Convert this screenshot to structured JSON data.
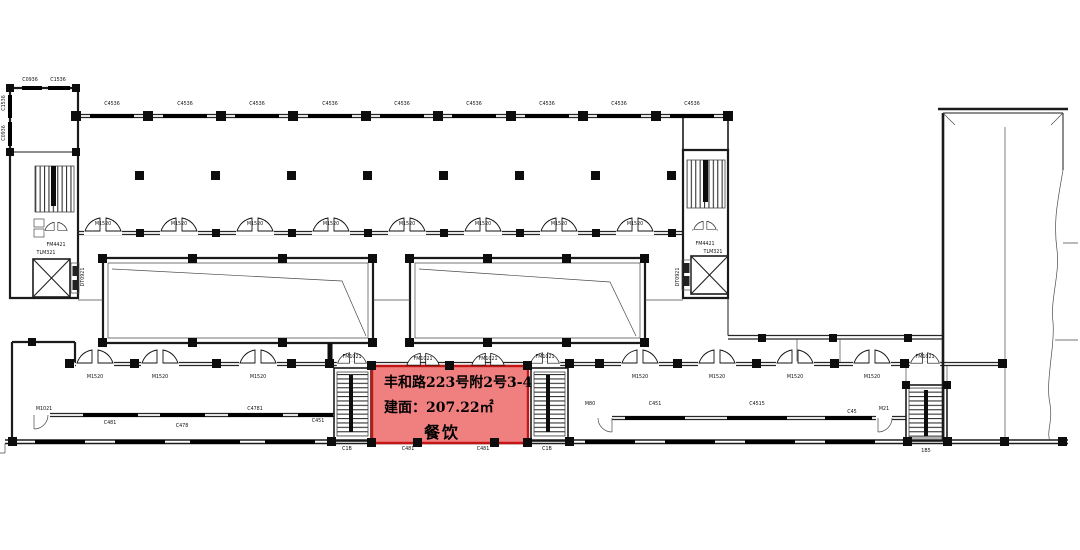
{
  "highlight": {
    "address": "丰和路223号附2号3-4",
    "area_label": "建面：207.22㎡",
    "usage": "餐饮",
    "fill_color": "#F08080",
    "border_color": "#C41414"
  },
  "plan": {
    "line_color": "#1b1b1b",
    "labels": [
      {
        "t": "C0936",
        "x": 30,
        "y": 80
      },
      {
        "t": "C1536",
        "x": 58,
        "y": 80
      },
      {
        "t": "C1536",
        "x": 4,
        "y": 103,
        "r": 1
      },
      {
        "t": "C0936",
        "x": 4,
        "y": 133,
        "r": 1
      },
      {
        "t": "C4536",
        "x": 112,
        "y": 104
      },
      {
        "t": "C4536",
        "x": 185,
        "y": 104
      },
      {
        "t": "C4536",
        "x": 257,
        "y": 104
      },
      {
        "t": "C4536",
        "x": 330,
        "y": 104
      },
      {
        "t": "C4536",
        "x": 402,
        "y": 104
      },
      {
        "t": "C4536",
        "x": 474,
        "y": 104
      },
      {
        "t": "C4536",
        "x": 547,
        "y": 104
      },
      {
        "t": "C4536",
        "x": 619,
        "y": 104
      },
      {
        "t": "C4536",
        "x": 692,
        "y": 104
      },
      {
        "t": "M1520",
        "x": 103,
        "y": 224
      },
      {
        "t": "M1520",
        "x": 179,
        "y": 224
      },
      {
        "t": "M1520",
        "x": 255,
        "y": 224
      },
      {
        "t": "M1520",
        "x": 331,
        "y": 224
      },
      {
        "t": "M1520",
        "x": 407,
        "y": 224
      },
      {
        "t": "M1520",
        "x": 483,
        "y": 224
      },
      {
        "t": "M1520",
        "x": 559,
        "y": 224
      },
      {
        "t": "M1520",
        "x": 635,
        "y": 224
      },
      {
        "t": "FM4421",
        "x": 56,
        "y": 245
      },
      {
        "t": "TLM321",
        "x": 46,
        "y": 253
      },
      {
        "t": "DT0921",
        "x": 83,
        "y": 277,
        "r": 1
      },
      {
        "t": "FM4421",
        "x": 705,
        "y": 244
      },
      {
        "t": "TLM321",
        "x": 713,
        "y": 252
      },
      {
        "t": "DT0921",
        "x": 678,
        "y": 277,
        "r": 1
      },
      {
        "t": "M1520",
        "x": 95,
        "y": 377
      },
      {
        "t": "M1520",
        "x": 160,
        "y": 377
      },
      {
        "t": "M1520",
        "x": 258,
        "y": 377
      },
      {
        "t": "M1520",
        "x": 640,
        "y": 377
      },
      {
        "t": "M1520",
        "x": 717,
        "y": 377
      },
      {
        "t": "M1520",
        "x": 795,
        "y": 377
      },
      {
        "t": "M1520",
        "x": 872,
        "y": 377
      },
      {
        "t": "FM1021",
        "x": 423,
        "y": 359
      },
      {
        "t": "FM1021",
        "x": 488,
        "y": 359
      },
      {
        "t": "FM1021",
        "x": 352,
        "y": 357
      },
      {
        "t": "FM1021",
        "x": 545,
        "y": 357
      },
      {
        "t": "FM1021",
        "x": 925,
        "y": 357
      },
      {
        "t": "M1021",
        "x": 44,
        "y": 409
      },
      {
        "t": "C481",
        "x": 110,
        "y": 423
      },
      {
        "t": "C478",
        "x": 182,
        "y": 426
      },
      {
        "t": "C4781",
        "x": 255,
        "y": 409
      },
      {
        "t": "C451",
        "x": 318,
        "y": 421
      },
      {
        "t": "C481",
        "x": 408,
        "y": 449
      },
      {
        "t": "C481",
        "x": 483,
        "y": 449
      },
      {
        "t": "C1B",
        "x": 347,
        "y": 449
      },
      {
        "t": "C1B",
        "x": 547,
        "y": 449
      },
      {
        "t": "1B5",
        "x": 926,
        "y": 451
      },
      {
        "t": "M80",
        "x": 590,
        "y": 404
      },
      {
        "t": "C451",
        "x": 655,
        "y": 404
      },
      {
        "t": "C4515",
        "x": 757,
        "y": 404
      },
      {
        "t": "C45",
        "x": 852,
        "y": 412
      },
      {
        "t": "M21",
        "x": 884,
        "y": 409
      }
    ]
  }
}
